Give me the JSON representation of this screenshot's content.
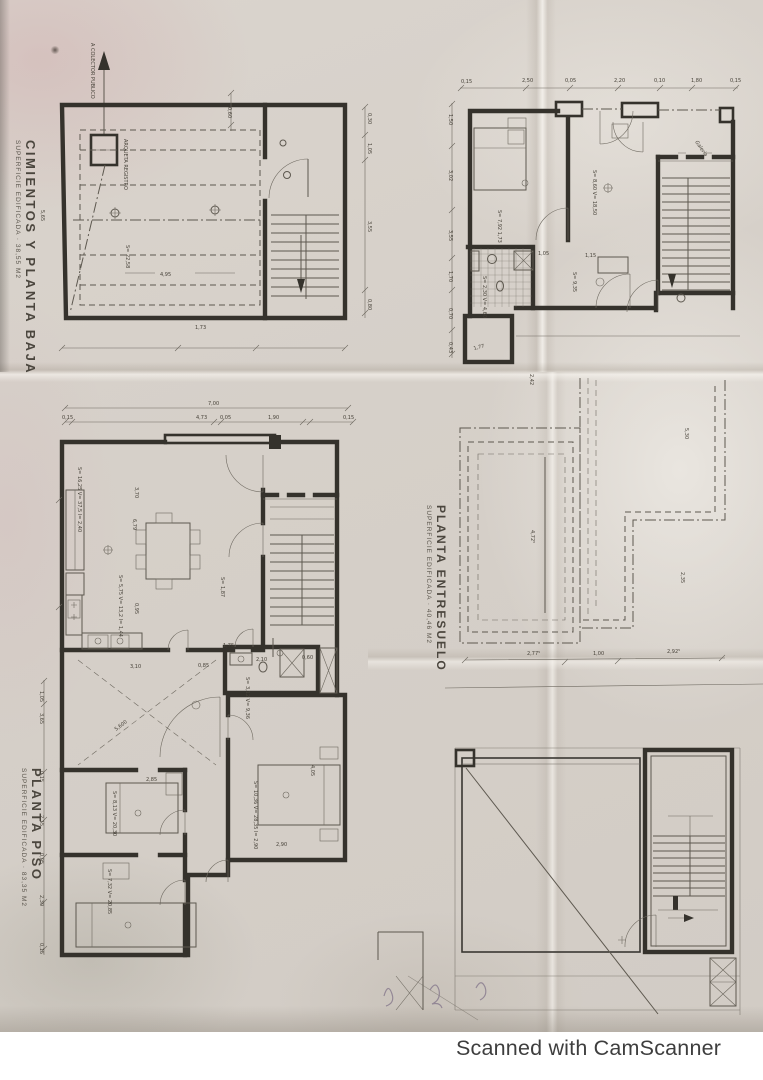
{
  "footer": "Scanned with CamScanner",
  "titles": {
    "cimientos": {
      "title": "CIMIENTOS Y PLANTA BAJA",
      "subtitle": "SUPERFICIE EDIFICADA · 38,55 M2"
    },
    "entresuelo": {
      "title": "PLANTA ENTRESUELO",
      "subtitle": "SUPERFICIE EDIFICADA · 40,46 M2"
    },
    "piso": {
      "title": "PLANTA PISO",
      "subtitle": "SUPERFICIE EDIFICADA · 83,35 M2"
    }
  },
  "cimientos": {
    "arrow_label": "A COLECTOR PUBLICO",
    "arqueta": "ARQUETA REGISTRO",
    "area": "S= 22,58",
    "d_495": "4,95",
    "d_060": "0,60",
    "d_173": "1,73",
    "d_565": "5,65",
    "dims_right": [
      "0,30",
      "1,05",
      "3,55",
      "0,80"
    ]
  },
  "baja": {
    "dims_top": [
      "0,15",
      "2,50",
      "0,05",
      "2,20",
      "0,10",
      "1,80",
      "0,15"
    ],
    "dims_left": [
      "1,50",
      "3,02",
      "3,55",
      "1,70",
      "0,70",
      "0,43"
    ],
    "label_dorm": "S= 8,60  V= 18,50",
    "label_estar": "S= 7,92   1,73",
    "label_comedor": "S= 9,35",
    "label_aseo": "S= 2,30  V= 4,60",
    "d_115": "1,15",
    "d_105": "1,05",
    "note_galeria": "Galeria",
    "d_177": "1,77"
  },
  "piso": {
    "d_total": "7,00",
    "dims_top": [
      "0,15",
      "4,73",
      "0,05",
      "1,90",
      "0,15"
    ],
    "dims_left": [
      "1,05",
      "3,65",
      "0,15",
      "2,15",
      "0,05",
      "2,30",
      "0,15"
    ],
    "label_estar": "S= 16,25  V= 37,5  I= 2,40",
    "d_370": "3,70",
    "d_679": "6,79",
    "label_cocina": "S= 5,75  V= 13,2  I= 1,44",
    "d_095": "0,95",
    "d_175": "1,75",
    "label_paso": "S= 1,87",
    "label_bano": "S= 3,12  V= 9,36",
    "d_310": "3,10",
    "d_085": "0,85",
    "d_210": "2,10",
    "d_060": "0,60",
    "label_dorm1": "S= 8,13  V= 20,30",
    "d_285": "2,85",
    "label_dorm2": "S= 7,32  V= 20,85",
    "label_dorm3": "S= 10,36  V= 28,35  I= 2,90",
    "d_290": "2,90",
    "d_405": "4,05",
    "d_5600": "5,600"
  },
  "entresuelo": {
    "d_530": "5,30",
    "d_4725": "4,72⁵",
    "d_235": "2,35",
    "d_2775": "2,77⁵",
    "d_100": "1,00",
    "d_2925": "2,92⁵",
    "d_242": "2,42"
  }
}
